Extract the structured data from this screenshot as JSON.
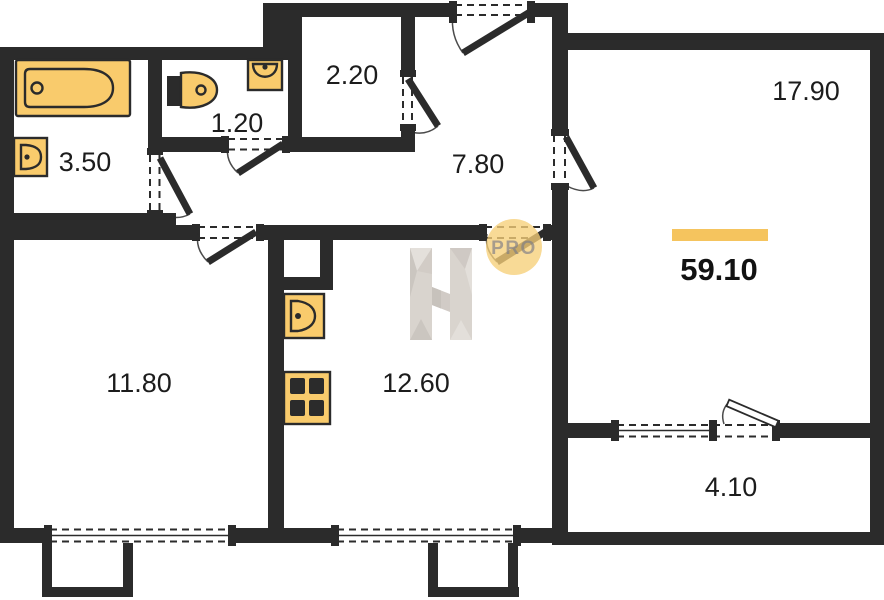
{
  "colors": {
    "wall": "#2B2B2B",
    "fixture_fill": "#F9CB6C",
    "accent": "#F5C45E",
    "watermark_gray": "#D7D2CC",
    "pro_badge_fill": "#F6CF79",
    "label_text": "#1C1C1C"
  },
  "watermark": {
    "logo": "H-faceted-logo",
    "badge_text": "PRO"
  },
  "floorplan": {
    "total_area": "59.10",
    "rooms": [
      {
        "id": "bathroom",
        "area": "3.50"
      },
      {
        "id": "wc",
        "area": "1.20"
      },
      {
        "id": "closet",
        "area": "2.20"
      },
      {
        "id": "hallway",
        "area": "7.80"
      },
      {
        "id": "living-room",
        "area": "17.90"
      },
      {
        "id": "bedroom",
        "area": "11.80"
      },
      {
        "id": "kitchen",
        "area": "12.60"
      },
      {
        "id": "balcony",
        "area": "4.10"
      }
    ],
    "fixtures": [
      "bathtub",
      "washbasin",
      "toilet",
      "corner-sink",
      "kitchen-sink",
      "stove"
    ]
  }
}
